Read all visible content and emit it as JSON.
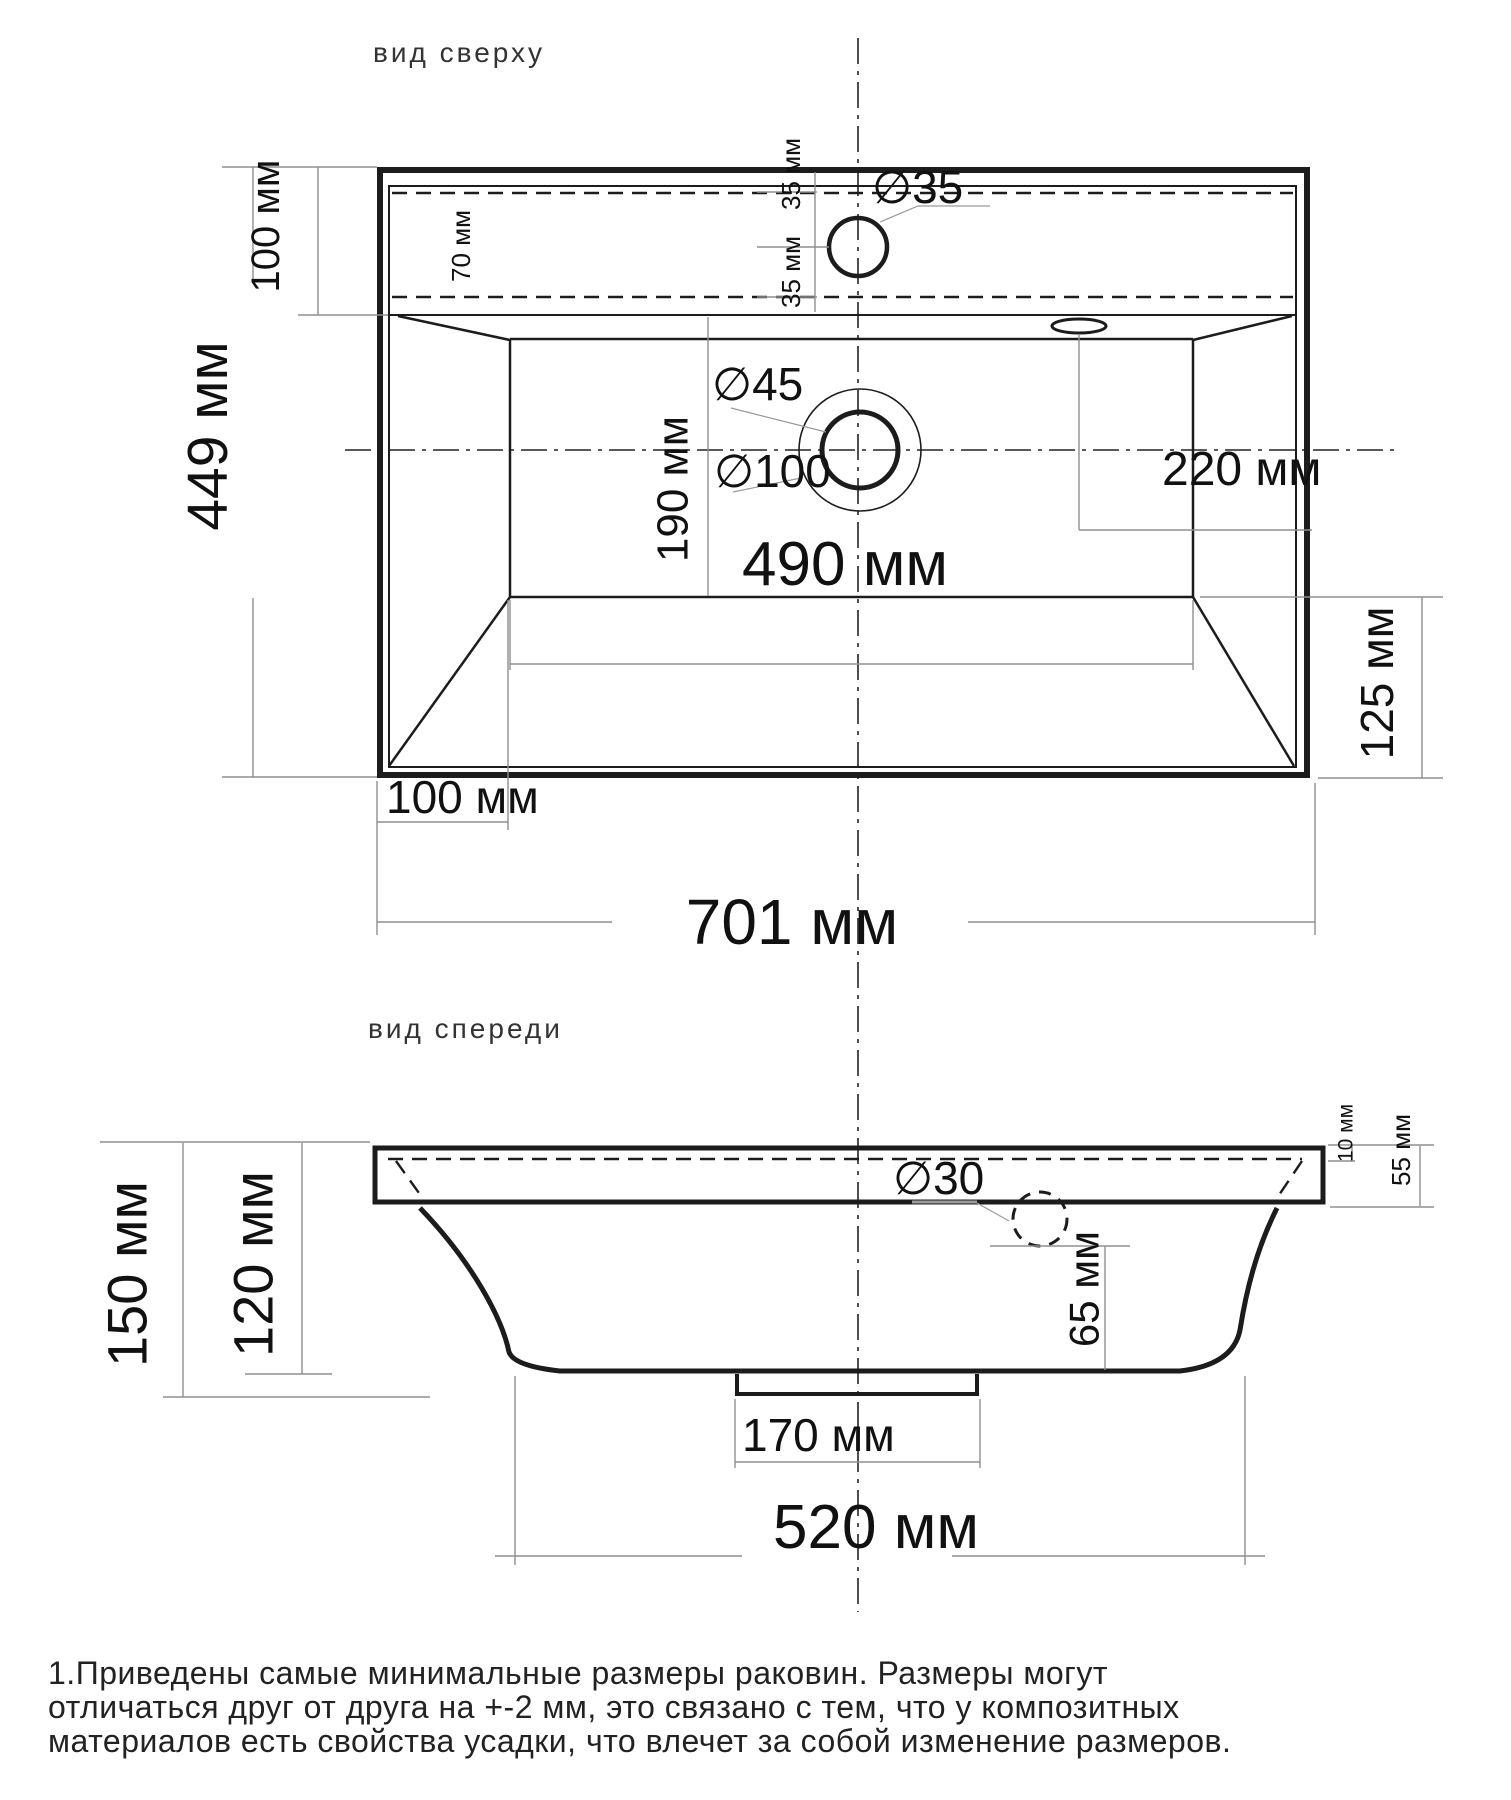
{
  "drawing": {
    "top_view": {
      "title": "вид сверху",
      "dims": {
        "ledge_depth_left": "100 мм",
        "overall_depth": "449 мм",
        "deck_hidden_width": "70 мм",
        "faucet_offset_upper": "35 мм",
        "faucet_offset_lower": "35 мм",
        "faucet_hole_diameter": "∅35",
        "drain_diameter": "∅45",
        "drain_recess_diameter": "∅100",
        "drain_offset_front": "190 мм",
        "overflow_offset_right": "220 мм",
        "basin_width": "490 мм",
        "side_offset_right": "125 мм",
        "corner_offset_bottom": "100 мм",
        "overall_width": "701 мм"
      }
    },
    "front_view": {
      "title": "вид спереди",
      "dims": {
        "overall_height": "150 мм",
        "bowl_height": "120 мм",
        "overflow_hole_diameter": "∅30",
        "rim_top_offset": "10 мм",
        "rim_height": "55 мм",
        "overflow_depth": "65 мм",
        "drain_stub_width": "170 мм",
        "bottom_width": "520 мм"
      }
    },
    "note_lines": [
      "1.Приведены самые минимальные размеры раковин. Размеры могут",
      "отличаться друг от друга на +-2 мм, это связано с тем, что у композитных",
      "материалов есть свойства усадки, что влечет за собой изменение размеров."
    ]
  }
}
